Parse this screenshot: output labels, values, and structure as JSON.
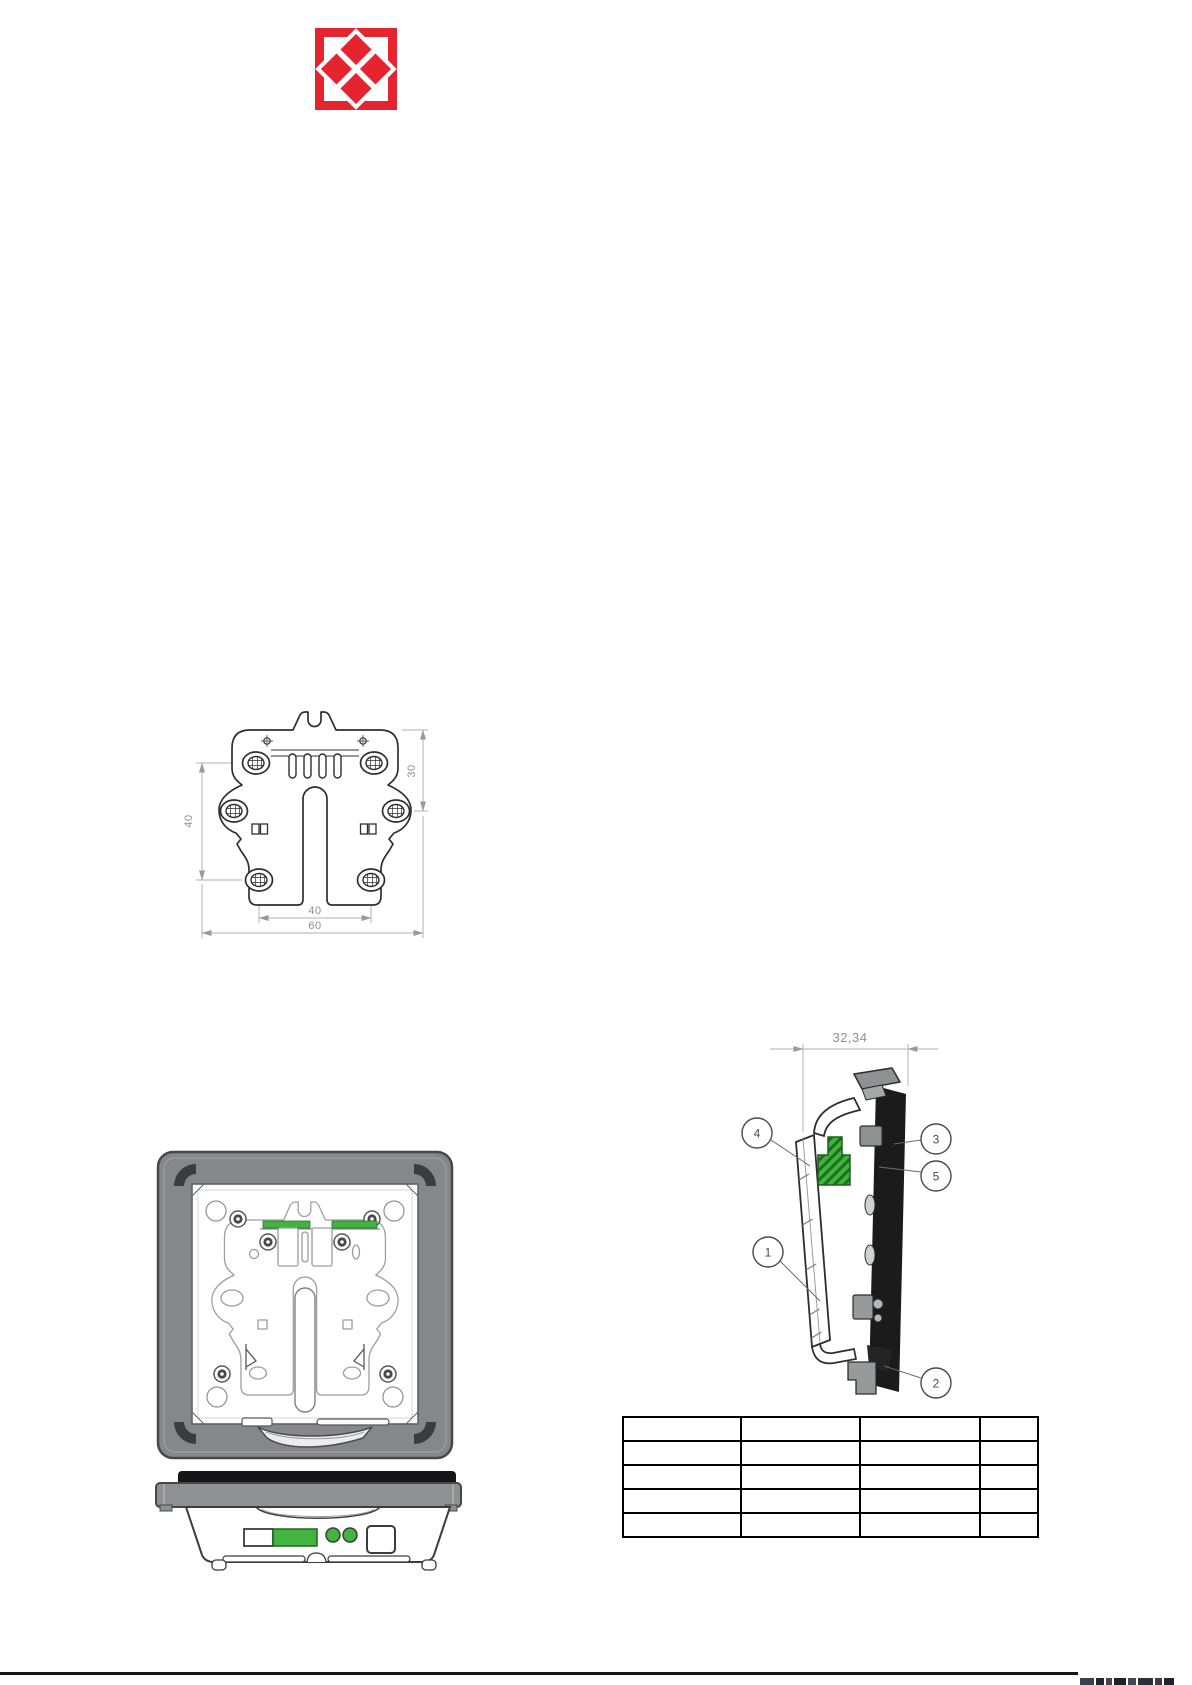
{
  "logo": {
    "color": "#e62430"
  },
  "bracket_view": {
    "dim_left": "40",
    "dim_right": "30",
    "dim_bottom_inner": "40",
    "dim_bottom_outer": "60"
  },
  "side_view": {
    "dim_width": "32,34",
    "callouts": [
      "1",
      "2",
      "3",
      "4",
      "5"
    ]
  },
  "parts_table": {
    "rows": 5,
    "columns": 4
  },
  "colors": {
    "accent_red": "#e62430",
    "part_green": "#3fb53f",
    "bezel_gray": "#85878a",
    "panel_black": "#1b1b1b",
    "dim_gray": "#8f8f8f"
  }
}
